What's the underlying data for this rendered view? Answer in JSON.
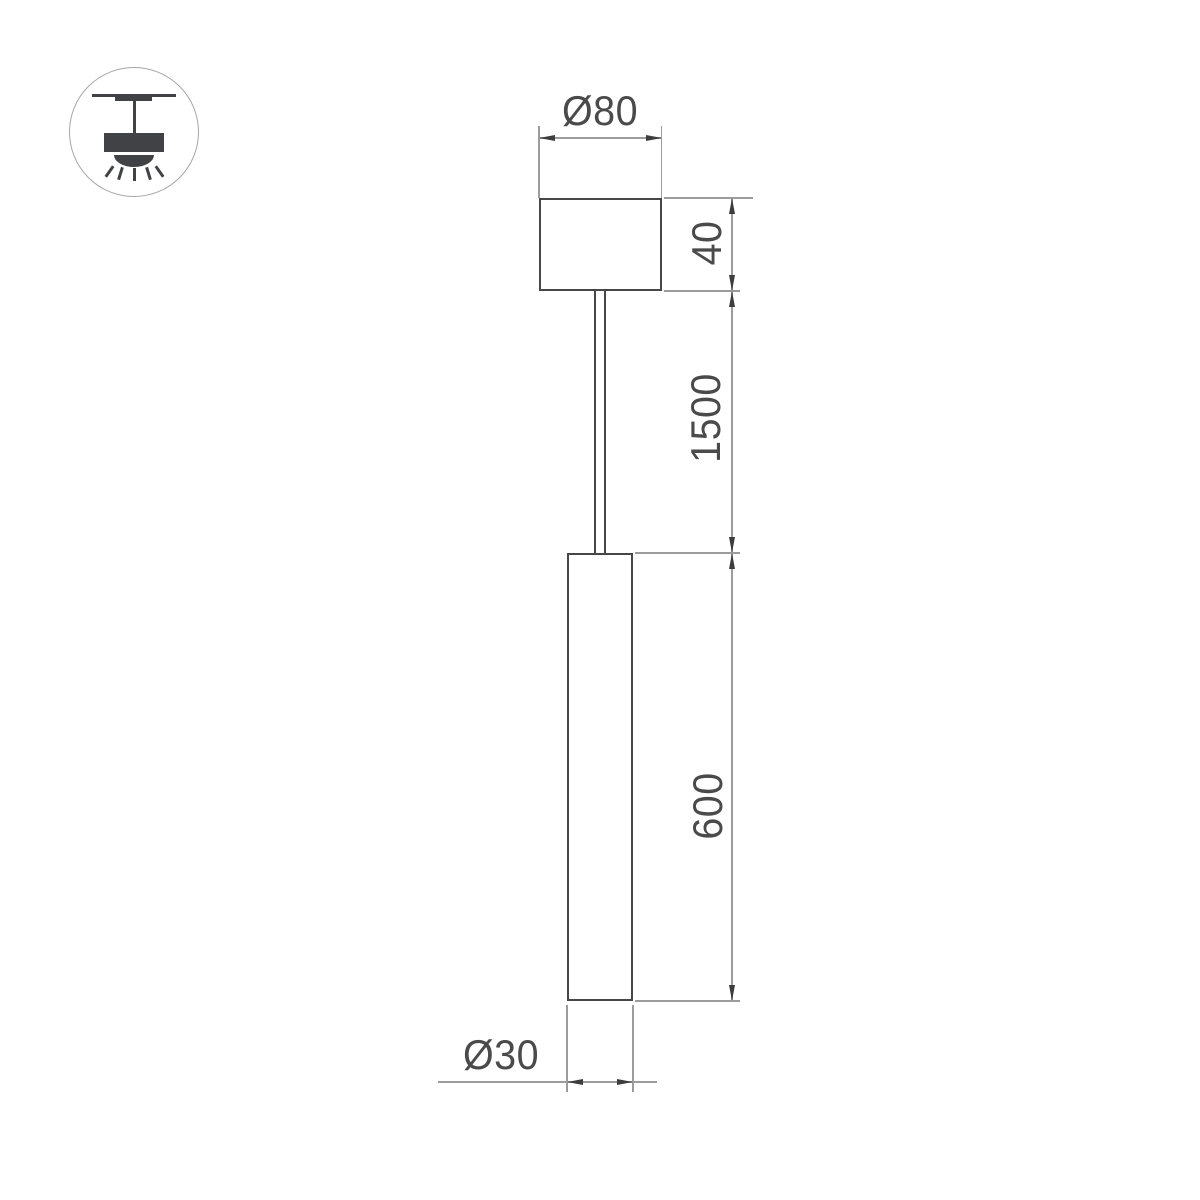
{
  "page": {
    "background": "#ffffff"
  },
  "colors": {
    "object_stroke": "#474747",
    "dimension_stroke": "#9c9c9c",
    "label_text": "#4a4a4a",
    "arrowhead": "#3d3d3d",
    "icon_fill": "#404245",
    "icon_circle_border": "#a6a6a6"
  },
  "icon": {
    "name": "ceiling-pendant-light-icon"
  },
  "labels": {
    "canopy_diameter": "Ø80",
    "canopy_height": "40",
    "suspension_length": "1500",
    "tube_length": "600",
    "tube_diameter": "Ø30"
  }
}
